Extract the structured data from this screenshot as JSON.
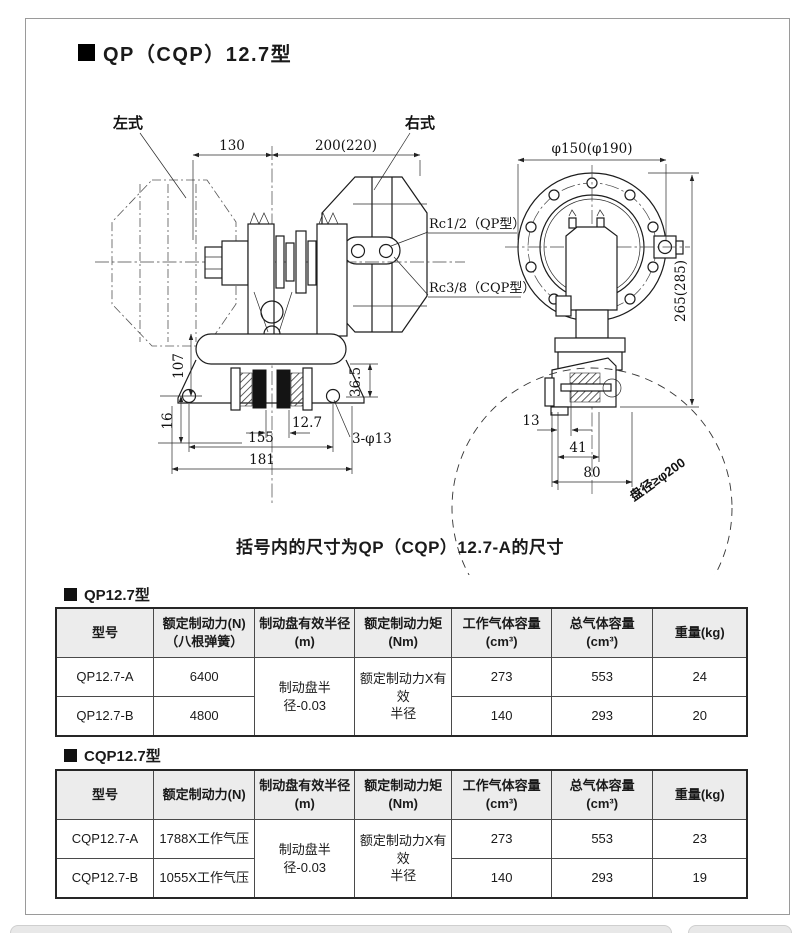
{
  "page": {
    "title": "QP（CQP）12.7型",
    "note": "括号内的尺寸为QP（CQP）12.7-A的尺寸"
  },
  "drawing": {
    "left_label": "左式",
    "right_label": "右式",
    "dim_130": "130",
    "dim_200": "200(220)",
    "port_qp": "Rc1/2（QP型）",
    "port_cqp": "Rc3/8（CQP型）",
    "dim_107": "107",
    "dim_36_5": "36.5",
    "dim_12_7": "12.7",
    "dim_16": "16",
    "dim_155": "155",
    "dim_181": "181",
    "holes_note": "3-φ13",
    "dim_flange": "φ150(φ190)",
    "dim_265": "265(285)",
    "dim_13": "13",
    "dim_41": "41",
    "dim_80": "80",
    "disc_note": "盘径≥φ200"
  },
  "tables": [
    {
      "heading": "QP12.7型",
      "columns": [
        "型号",
        "额定制动力(N)\n（八根弹簧）",
        "制动盘有效半径\n(m)",
        "额定制动力矩\n(Nm)",
        "工作气体容量\n(cm³)",
        "总气体容量\n(cm³)",
        "重量(kg)"
      ],
      "merged": {
        "radius": "制动盘半径-0.03",
        "torque": "额定制动力X有效\n半径"
      },
      "rows": [
        {
          "model": "QP12.7-A",
          "force": "6400",
          "work": "273",
          "total": "553",
          "weight": "24"
        },
        {
          "model": "QP12.7-B",
          "force": "4800",
          "work": "140",
          "total": "293",
          "weight": "20"
        }
      ]
    },
    {
      "heading": "CQP12.7型",
      "columns": [
        "型号",
        "额定制动力(N)",
        "制动盘有效半径\n(m)",
        "额定制动力矩\n(Nm)",
        "工作气体容量\n(cm³)",
        "总气体容量\n(cm³)",
        "重量(kg)"
      ],
      "merged": {
        "radius": "制动盘半径-0.03",
        "torque": "额定制动力X有效\n半径"
      },
      "rows": [
        {
          "model": "CQP12.7-A",
          "force": "1788X工作气压",
          "work": "273",
          "total": "553",
          "weight": "23"
        },
        {
          "model": "CQP12.7-B",
          "force": "1055X工作气压",
          "work": "140",
          "total": "293",
          "weight": "19"
        }
      ]
    }
  ]
}
